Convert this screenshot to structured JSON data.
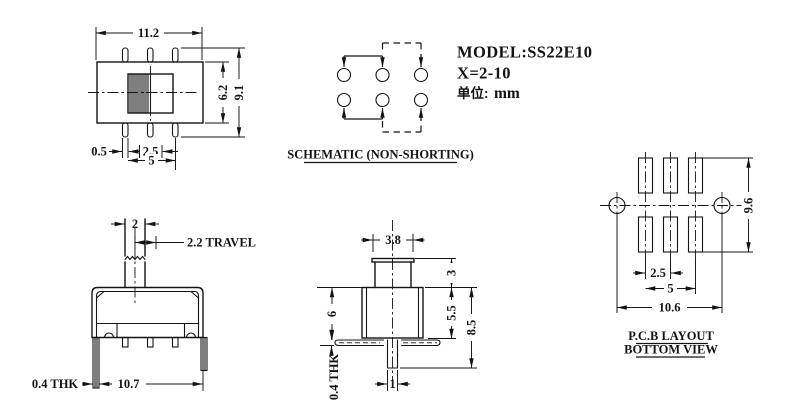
{
  "drawing": {
    "title_block": {
      "model": "MODEL:SS22E10",
      "x_range": "X=2-10",
      "unit_label": "单位:",
      "unit_value": "mm"
    },
    "top_view": {
      "width": "11.2",
      "body_height": "6.2",
      "total_height": "9.1",
      "pin_width": "0.5",
      "pin_pitch": "2.5",
      "pin_span": "5"
    },
    "schematic": {
      "caption": "SCHEMATIC (NON-SHORTING)"
    },
    "front_view": {
      "stem_width": "2",
      "travel": "2.2 TRAVEL",
      "leg_thickness": "0.4 THK",
      "body_width": "10.7"
    },
    "side_view": {
      "knob_width": "3.8",
      "knob_height": "3",
      "body_height": "5.5",
      "overall_height": "8.5",
      "upper_height": "6",
      "foot_thickness": "0.4 THK",
      "pin_width": "1"
    },
    "pcb_layout": {
      "pad_column_height": "9.6",
      "pad_pitch": "2.5",
      "pad_span": "5",
      "hole_span": "10.6",
      "caption_line1": "P.C.B LAYOUT",
      "caption_line2": "BOTTOM VIEW"
    }
  }
}
